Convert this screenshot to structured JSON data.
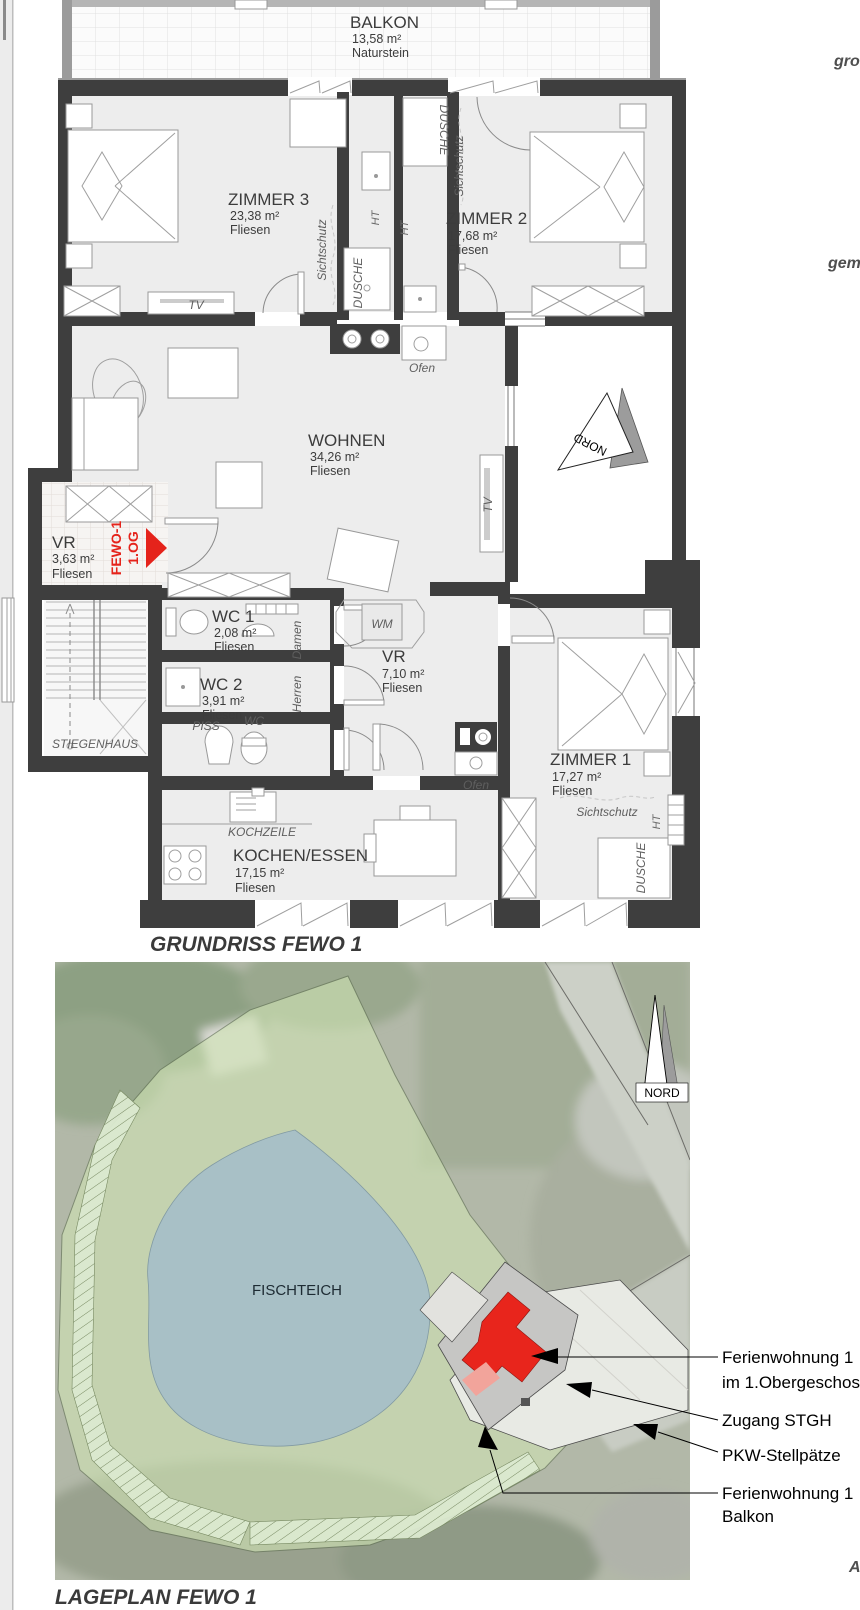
{
  "floor_plan": {
    "title": "GRUNDRISS FEWO 1",
    "balcony": {
      "name": "BALKON",
      "area": "13,58 m²",
      "floor": "Naturstein"
    },
    "rooms": [
      {
        "name": "ZIMMER 3",
        "area": "23,38 m²",
        "floor": "Fliesen"
      },
      {
        "name": "ZIMMER 2",
        "area": "17,68 m²",
        "floor": "Fliesen"
      },
      {
        "name": "WOHNEN",
        "area": "34,26 m²",
        "floor": "Fliesen"
      },
      {
        "name": "VR",
        "area": "3,63 m²",
        "floor": "Fliesen"
      },
      {
        "name": "WC 1",
        "area": "2,08 m²",
        "floor": "Fliesen"
      },
      {
        "name": "WC 2",
        "area": "3,91 m²",
        "floor": "Fliesen"
      },
      {
        "name": "VR",
        "area": "7,10 m²",
        "floor": "Fliesen"
      },
      {
        "name": "ZIMMER 1",
        "area": "17,27 m²",
        "floor": "Fliesen"
      },
      {
        "name": "KOCHEN/ESSEN",
        "area": "17,15 m²",
        "floor": "Fliesen"
      }
    ],
    "labels": {
      "stiegenhaus": "STIEGENHAUS",
      "kochzeile": "KOCHZEILE",
      "piss": "PISS",
      "wc": "WC",
      "wm": "WM",
      "ofen": "Ofen",
      "tv": "TV",
      "ht": "HT",
      "dusche": "DUSCHE",
      "sichtschutz": "Sichtschutz",
      "damen": "Damen",
      "herren": "Herren",
      "nord": "NORD"
    },
    "unit_marker": {
      "line1": "FEWO-1",
      "line2": "1.OG"
    }
  },
  "site_plan": {
    "title": "LAGEPLAN FEWO 1",
    "pond_label": "FISCHTEICH",
    "north_label": "NORD",
    "annotations": [
      {
        "line1": "Ferienwohnung 1",
        "line2": "im 1.Obergeschoss"
      },
      {
        "line1": "Zugang STGH",
        "line2": ""
      },
      {
        "line1": "PKW-Stellpätze",
        "line2": ""
      },
      {
        "line1": "Ferienwohnung 1",
        "line2": "Balkon"
      }
    ]
  },
  "margin_notes": {
    "top_partial": "gro",
    "middle_partial": "gem",
    "bottom_partial": "A"
  },
  "colors": {
    "wall": "#3e3e3e",
    "accent_red": "#e5231b",
    "room_fill": "#ededed",
    "site_green": "#cfe3b4",
    "pond_blue": "#a6bfc9",
    "roof_grey": "#c6c6c4",
    "parking": "#e8eae4",
    "balcony_pink": "#f2a49b"
  }
}
